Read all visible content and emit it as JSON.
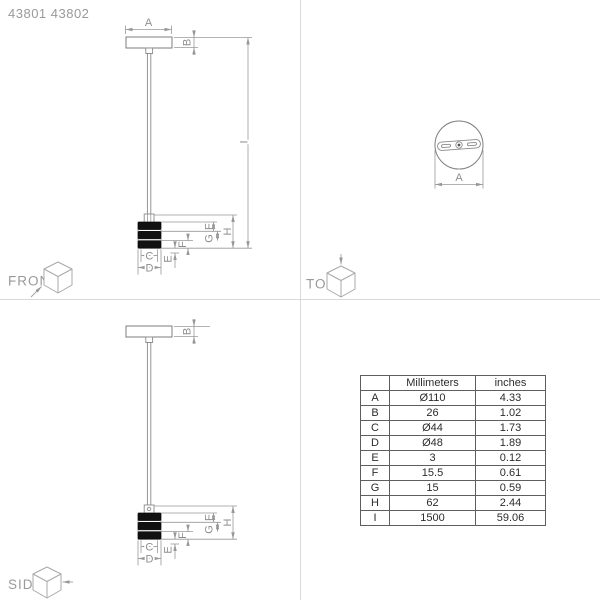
{
  "product_code": "43801 43802",
  "views": {
    "front_label": "FRONT",
    "top_label": "TOP",
    "side_label": "SIDE"
  },
  "dims": {
    "A": "A",
    "B": "B",
    "C": "C",
    "D": "D",
    "E": "E",
    "F": "F",
    "G": "G",
    "H": "H",
    "I": "I"
  },
  "table": {
    "col_headers": {
      "dim": "",
      "mm": "Millimeters",
      "inches": "inches"
    },
    "rows": [
      {
        "dim": "A",
        "mm": "Ø110",
        "inches": "4.33"
      },
      {
        "dim": "B",
        "mm": "26",
        "inches": "1.02"
      },
      {
        "dim": "C",
        "mm": "Ø44",
        "inches": "1.73"
      },
      {
        "dim": "D",
        "mm": "Ø48",
        "inches": "1.89"
      },
      {
        "dim": "E",
        "mm": "3",
        "inches": "0.12"
      },
      {
        "dim": "F",
        "mm": "15.5",
        "inches": "0.61"
      },
      {
        "dim": "G",
        "mm": "15",
        "inches": "0.59"
      },
      {
        "dim": "H",
        "mm": "62",
        "inches": "2.44"
      },
      {
        "dim": "I",
        "mm": "1500",
        "inches": "59.06"
      }
    ]
  },
  "colors": {
    "object_line": "#7e7e7e",
    "dimension_line": "#989898",
    "band_fill": "#111111",
    "label_gray": "#8e8e8e",
    "table_border": "#5e5e5e",
    "table_text": "#2c2c2c",
    "divider": "#d9d9d9"
  }
}
